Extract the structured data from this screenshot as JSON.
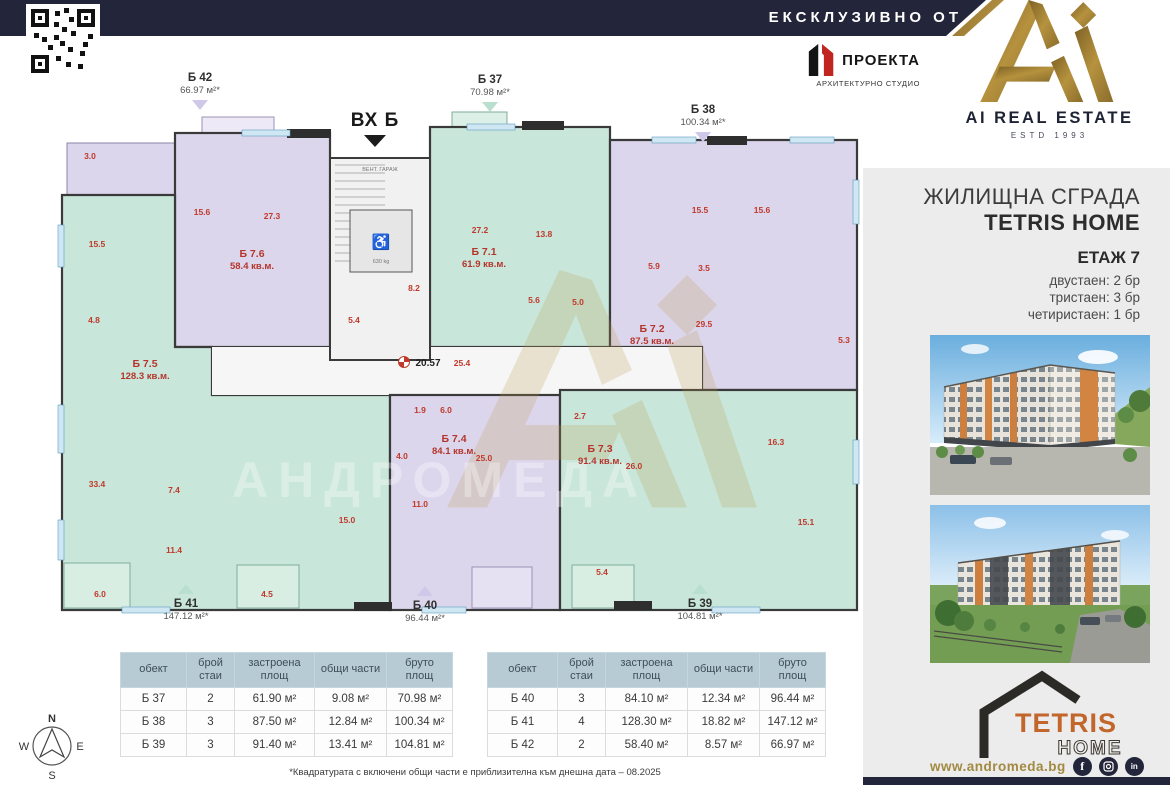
{
  "banner": {
    "text": "ЕКСКЛУЗИВНО ОТ"
  },
  "brand": {
    "name": "AI REAL ESTATE",
    "estd": "ESTD 1993"
  },
  "architect": {
    "name": "ПРОЕКТА",
    "tagline": "АРХИТЕКТУРНО СТУДИО"
  },
  "entrance": {
    "label": "ВХ Б"
  },
  "sidebar": {
    "building_type": "ЖИЛИЩНА СГРАДА",
    "building_name": "TETRIS HOME",
    "floor_label": "ЕТАЖ 7",
    "availability": [
      {
        "label": "двустаен: 2 бр"
      },
      {
        "label": "тристаен: 3 бр"
      },
      {
        "label": "четиристаен: 1 бр"
      }
    ],
    "logo": {
      "top": "TETRIS",
      "bottom": "HOME"
    },
    "website": "www.andromeda.bg",
    "social": [
      "facebook",
      "instagram",
      "linkedin"
    ]
  },
  "callouts": {
    "b42": {
      "id": "Б 42",
      "area": "66.97 м²*"
    },
    "b37": {
      "id": "Б 37",
      "area": "70.98 м²*"
    },
    "b38": {
      "id": "Б 38",
      "area": "100.34 м²*"
    },
    "b41": {
      "id": "Б 41",
      "area": "147.12 м²*"
    },
    "b40": {
      "id": "Б 40",
      "area": "96.44 м²*"
    },
    "b39": {
      "id": "Б 39",
      "area": "104.81 м²*"
    }
  },
  "plan": {
    "units": {
      "u76": {
        "id": "Б 7.6",
        "area": "58.4 кв.м."
      },
      "u75": {
        "id": "Б 7.5",
        "area": "128.3 кв.м."
      },
      "u71": {
        "id": "Б 7.1",
        "area": "61.9 кв.м."
      },
      "u72": {
        "id": "Б 7.2",
        "area": "87.5 кв.м."
      },
      "u74": {
        "id": "Б 7.4",
        "area": "84.1 кв.м."
      },
      "u73": {
        "id": "Б 7.3",
        "area": "91.4 кв.м."
      }
    },
    "core": {
      "vent": "ВЕНТ. ГАРАЖ",
      "elevator": "630 kg"
    },
    "dims": {
      "width": "20.57",
      "hall": "25.4"
    },
    "watermark": "АНДРОМЕДА",
    "rooms": [
      "3.0",
      "15.6",
      "27.3",
      "15.5",
      "4.8",
      "33.4",
      "7.4",
      "11.4",
      "15.0",
      "6.0",
      "4.5",
      "27.2",
      "13.8",
      "5.6",
      "5.0",
      "15.5",
      "15.6",
      "5.9",
      "3.5",
      "29.5",
      "5.3",
      "8.2",
      "5.4",
      "1.9",
      "6.0",
      "4.0",
      "25.0",
      "11.0",
      "2.7",
      "26.0",
      "16.3",
      "15.1",
      "5.4"
    ]
  },
  "tables": {
    "headers": [
      "обект",
      "брой стаи",
      "застроена площ",
      "общи части",
      "бруто площ"
    ],
    "left": [
      [
        "Б 37",
        "2",
        "61.90 м²",
        "9.08 м²",
        "70.98 м²"
      ],
      [
        "Б 38",
        "3",
        "87.50 м²",
        "12.84 м²",
        "100.34 м²"
      ],
      [
        "Б 39",
        "3",
        "91.40 м²",
        "13.41 м²",
        "104.81 м²"
      ]
    ],
    "right": [
      [
        "Б 40",
        "3",
        "84.10 м²",
        "12.34 м²",
        "96.44 м²"
      ],
      [
        "Б 41",
        "4",
        "128.30 м²",
        "18.82 м²",
        "147.12 м²"
      ],
      [
        "Б 42",
        "2",
        "58.40 м²",
        "8.57 м²",
        "66.97 м²"
      ]
    ]
  },
  "footnote": "*Квадратурата с включени общи части е приблизителна към днешна дата – 08.2025",
  "compass": {
    "n": "N",
    "e": "E",
    "s": "S",
    "w": "W"
  },
  "colors": {
    "navy": "#23263a",
    "gold": "#a98b3f",
    "lavender": "#dcd6ec",
    "mint": "#c9e6da",
    "red": "#c0392b",
    "table_header": "#b6cbd4"
  }
}
